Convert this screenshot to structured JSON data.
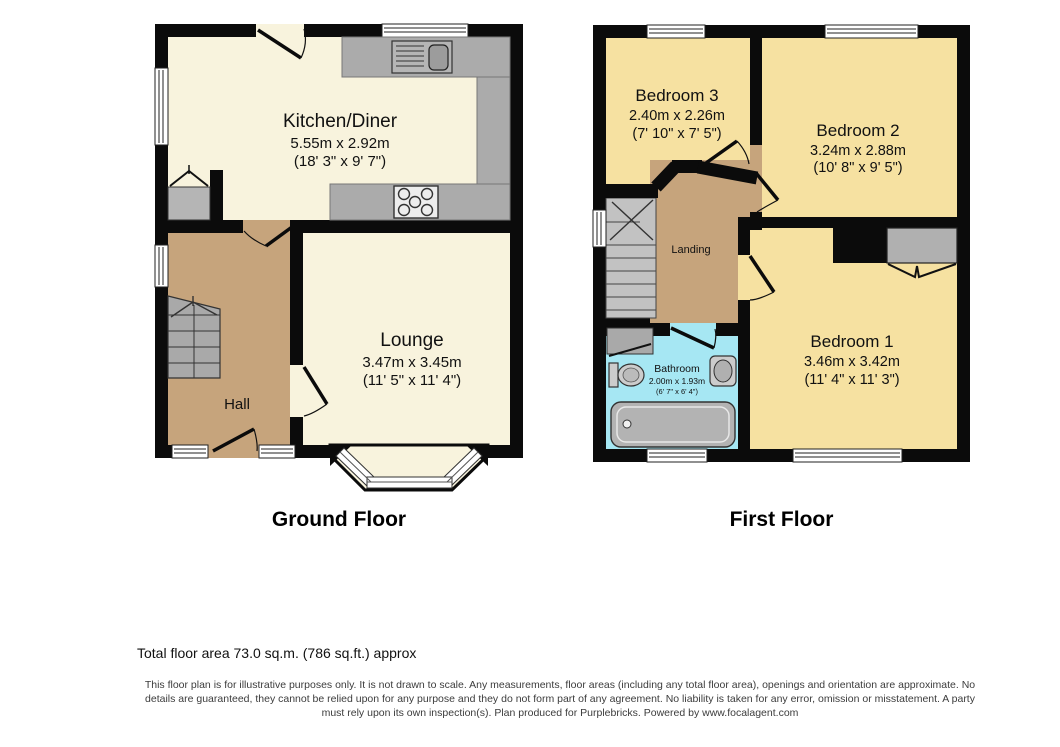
{
  "colors": {
    "wall": "#0b0b0b",
    "cream": "#f8f3dd",
    "tan": "#c6a47c",
    "yellow": "#f6e1a1",
    "cyan": "#a6e7f3",
    "counter_gray": "#ababab",
    "stair_gray_gf": "#a9a9a9",
    "stair_gray_ff": "#c2c2c2",
    "wardrobe_gray": "#b0b0b0",
    "page_bg": "#ffffff"
  },
  "ground_floor": {
    "title": "Ground Floor",
    "kitchen": {
      "name": "Kitchen/Diner",
      "dim_m": "5.55m x 2.92m",
      "dim_ft": "(18' 3\" x 9' 7\")"
    },
    "lounge": {
      "name": "Lounge",
      "dim_m": "3.47m x 3.45m",
      "dim_ft": "(11' 5\" x 11' 4\")"
    },
    "hall": {
      "name": "Hall"
    }
  },
  "first_floor": {
    "title": "First Floor",
    "bedroom3": {
      "name": "Bedroom 3",
      "dim_m": "2.40m x 2.26m",
      "dim_ft": "(7' 10\" x 7' 5\")"
    },
    "bedroom2": {
      "name": "Bedroom 2",
      "dim_m": "3.24m x 2.88m",
      "dim_ft": "(10' 8\" x 9' 5\")"
    },
    "bedroom1": {
      "name": "Bedroom 1",
      "dim_m": "3.46m x 3.42m",
      "dim_ft": "(11' 4\" x 11' 3\")"
    },
    "landing": {
      "name": "Landing"
    },
    "bathroom": {
      "name": "Bathroom",
      "dim_m": "2.00m x 1.93m",
      "dim_ft": "(6' 7\" x 6' 4\")"
    }
  },
  "footer": {
    "total_area": "Total floor area 73.0 sq.m. (786 sq.ft.) approx",
    "disclaimer": "This floor plan is for illustrative purposes only. It is not drawn to scale. Any measurements, floor areas (including any total floor area), openings and orientation are approximate. No details are guaranteed, they cannot be relied upon for any purpose and they do not form part of any agreement. No liability is taken for any error, omission or misstatement. A party must rely upon its own inspection(s). Plan produced for Purplebricks. Powered by www.focalagent.com"
  }
}
